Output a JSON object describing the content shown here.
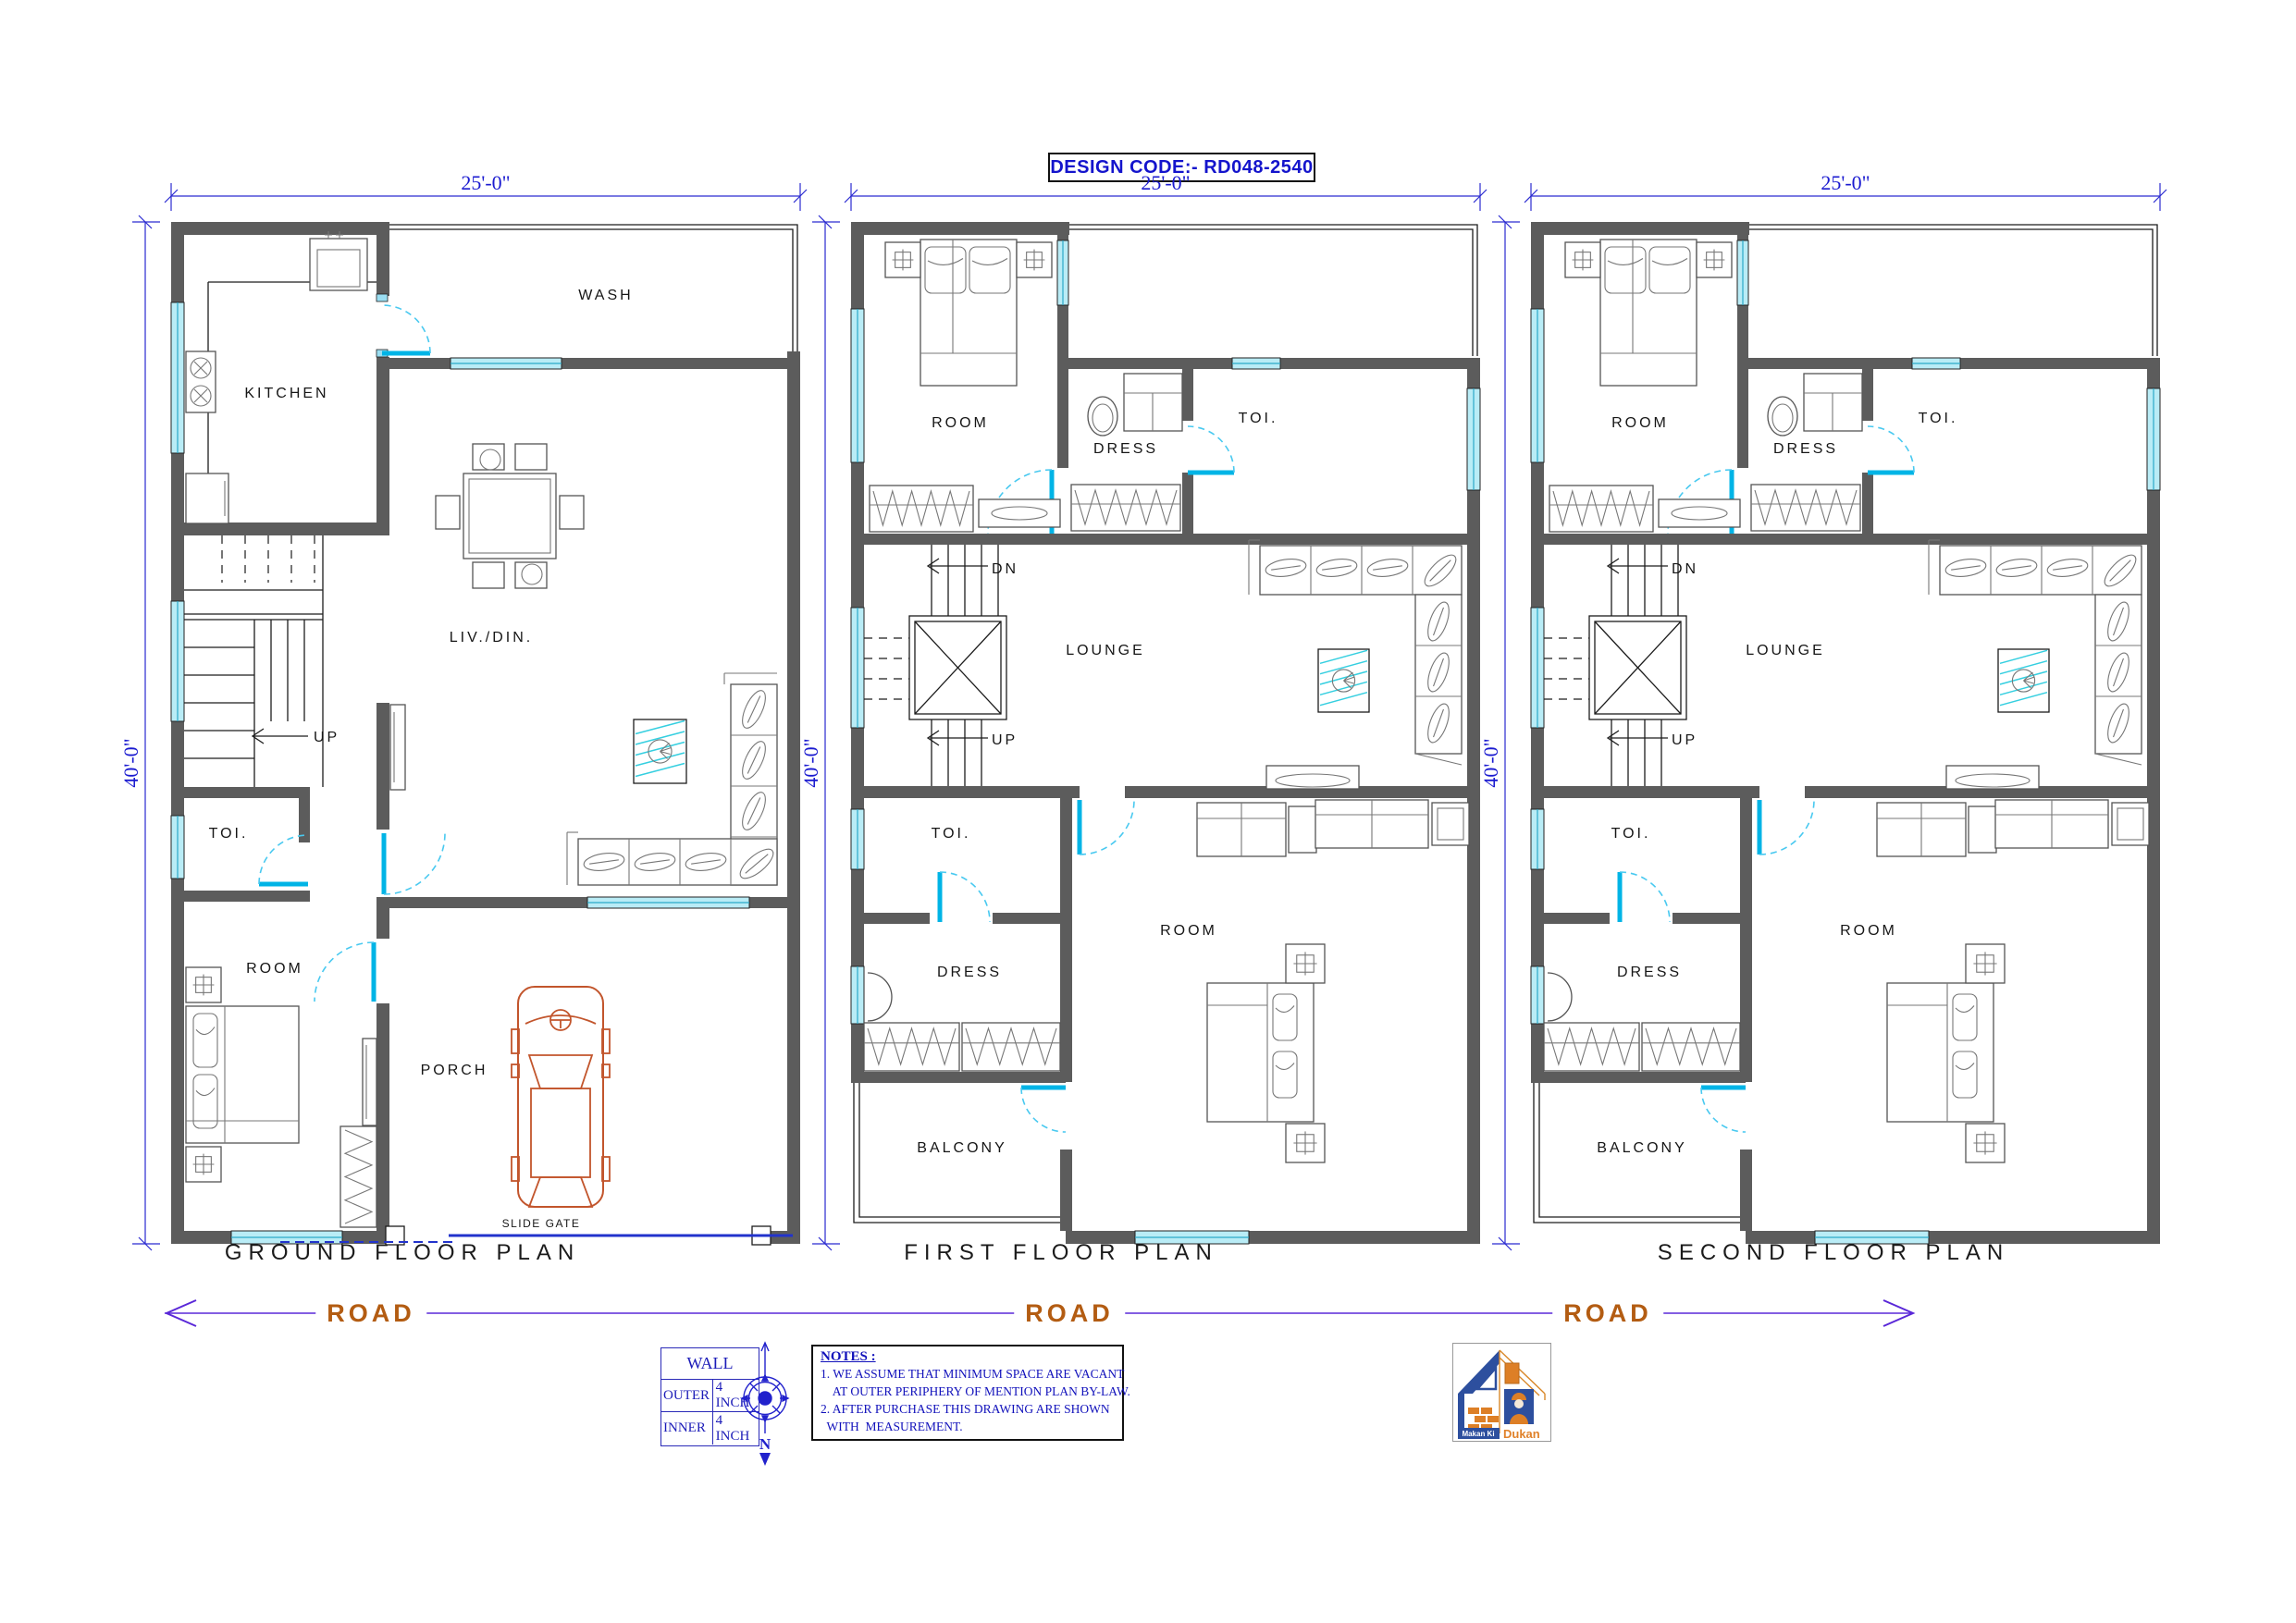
{
  "design_code": "DESIGN CODE:- RD048-2540",
  "dimensions": {
    "width": "25'-0\"",
    "height": "40'-0\""
  },
  "road": {
    "label": "ROAD"
  },
  "plans": [
    {
      "title": "GROUND FLOOR PLAN",
      "rooms": {
        "kitchen": "KITCHEN",
        "wash": "WASH",
        "livdin": "LIV./DIN.",
        "up": "UP",
        "toi": "TOI.",
        "room": "ROOM",
        "porch": "PORCH",
        "slide_gate": "SLIDE GATE"
      }
    },
    {
      "title": "FIRST FLOOR PLAN",
      "rooms": {
        "room_top": "ROOM",
        "dress_top": "DRESS",
        "toi_top": "TOI.",
        "dn": "DN",
        "up": "UP",
        "lounge": "LOUNGE",
        "toi_mid": "TOI.",
        "dress_bottom": "DRESS",
        "room_bottom": "ROOM",
        "balcony": "BALCONY"
      }
    },
    {
      "title": "SECOND FLOOR PLAN",
      "rooms": {
        "room_top": "ROOM",
        "dress_top": "DRESS",
        "toi_top": "TOI.",
        "dn": "DN",
        "up": "UP",
        "lounge": "LOUNGE",
        "toi_mid": "TOI.",
        "dress_bottom": "DRESS",
        "room_bottom": "ROOM",
        "balcony": "BALCONY"
      }
    }
  ],
  "wall_table": {
    "title": "WALL",
    "rows": [
      [
        "OUTER",
        "4 INCH"
      ],
      [
        "INNER",
        "4 INCH"
      ]
    ]
  },
  "compass": {
    "north": "N"
  },
  "notes": {
    "title": "NOTES :",
    "lines": [
      "1. WE ASSUME THAT MINIMUM SPACE ARE VACANT",
      "    AT OUTER PERIPHERY OF MENTION PLAN BY-LAW.",
      "2. AFTER PURCHASE THIS DRAWING ARE SHOWN",
      "  WITH  MEASUREMENT."
    ]
  },
  "logo": {
    "line1": "Makan Ki",
    "line2": "Dukan"
  }
}
